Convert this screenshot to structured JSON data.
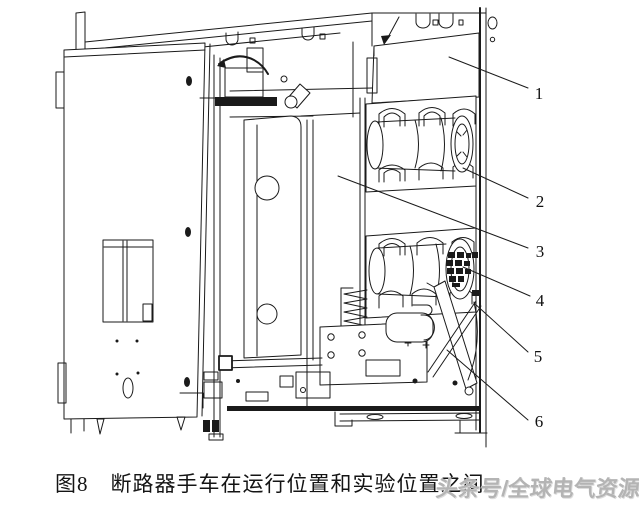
{
  "figure": {
    "caption": "图8　断路器手车在运行位置和实验位置之间",
    "watermark": "头条号/全球电气资源"
  },
  "callouts": [
    {
      "num": "1"
    },
    {
      "num": "2"
    },
    {
      "num": "3"
    },
    {
      "num": "4"
    },
    {
      "num": "5"
    },
    {
      "num": "6"
    }
  ],
  "colors": {
    "background": "#ffffff",
    "line": "#1a1a1a",
    "caption_text": "#141414",
    "watermark_text": "#b4b4b4"
  }
}
